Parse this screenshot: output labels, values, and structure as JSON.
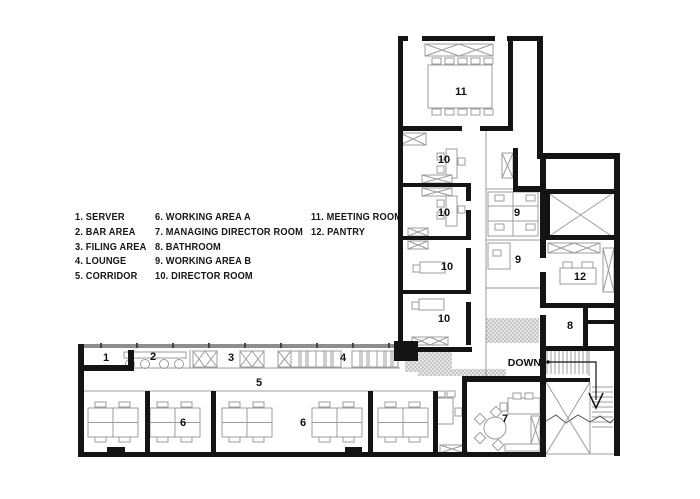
{
  "legend": {
    "columns": [
      {
        "items": [
          "1. SERVER",
          "2. BAR AREA",
          "3. FILING AREA",
          "4. LOUNGE",
          "5. CORRIDOR"
        ]
      },
      {
        "items": [
          "6. WORKING AREA A",
          "7. MANAGING DIRECTOR ROOM",
          "8. BATHROOM",
          "9. WORKING AREA B",
          "10. DIRECTOR ROOM"
        ]
      },
      {
        "items": [
          "11. MEETING ROOM",
          "12. PANTRY"
        ]
      }
    ]
  },
  "plan": {
    "room_labels": [
      {
        "text": "11",
        "x": 461,
        "y": 95,
        "room": "meeting-room"
      },
      {
        "text": "10",
        "x": 444,
        "y": 163,
        "room": "director-room-1"
      },
      {
        "text": "10",
        "x": 444,
        "y": 216,
        "room": "director-room-2"
      },
      {
        "text": "10",
        "x": 447,
        "y": 270,
        "room": "director-room-3"
      },
      {
        "text": "10",
        "x": 444,
        "y": 322,
        "room": "director-room-4"
      },
      {
        "text": "9",
        "x": 517,
        "y": 216,
        "room": "working-area-b-1"
      },
      {
        "text": "9",
        "x": 518,
        "y": 263,
        "room": "working-area-b-2"
      },
      {
        "text": "12",
        "x": 580,
        "y": 280,
        "room": "pantry"
      },
      {
        "text": "8",
        "x": 570,
        "y": 329,
        "room": "bathroom"
      },
      {
        "text": "7",
        "x": 505,
        "y": 422,
        "room": "managing-director-room"
      },
      {
        "text": "1",
        "x": 106,
        "y": 361,
        "room": "server"
      },
      {
        "text": "2",
        "x": 153,
        "y": 360,
        "room": "bar-area"
      },
      {
        "text": "3",
        "x": 231,
        "y": 361,
        "room": "filing-area"
      },
      {
        "text": "4",
        "x": 343,
        "y": 361,
        "room": "lounge"
      },
      {
        "text": "5",
        "x": 259,
        "y": 386,
        "room": "corridor"
      },
      {
        "text": "6",
        "x": 183,
        "y": 426,
        "room": "working-area-a-1"
      },
      {
        "text": "6",
        "x": 303,
        "y": 426,
        "room": "working-area-a-2"
      }
    ],
    "down_label": {
      "text": "DOWN"
    },
    "colors": {
      "wall": "#141414",
      "furniture": "#9c9c9c",
      "window_band": "#8e8e8e",
      "stipple_bg": "#e4e4e4",
      "stipple_dot": "#9f9f9f",
      "background": "#ffffff"
    }
  }
}
